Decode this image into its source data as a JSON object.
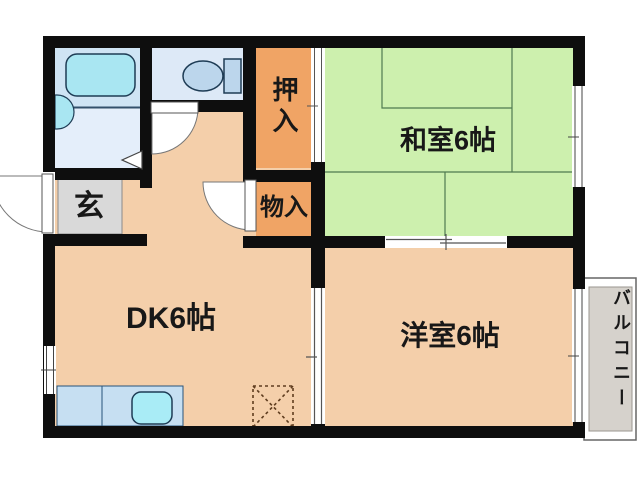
{
  "floorplan": {
    "rooms": {
      "genkan": "玄",
      "dk": "DK6帖",
      "washitsu": "和室6帖",
      "yoshitsu": "洋室6帖",
      "oshiire": "押入",
      "monoire": "物入",
      "balcony": "バルコニー"
    },
    "colors": {
      "wall": "#0e0e0e",
      "floor": "#f4cfaa",
      "tatami": "#cdf0ae",
      "tatami_line": "#4f7a50",
      "closet": "#f0a465",
      "genkan": "#d9d9d9",
      "balcony": "#d6d2cc",
      "bathroom": "#cfe4f4",
      "washroom": "#e4eefa",
      "toilet_room": "#dde9f7",
      "fixture": "#a9e6f2",
      "counter": "#c6dff2"
    }
  }
}
